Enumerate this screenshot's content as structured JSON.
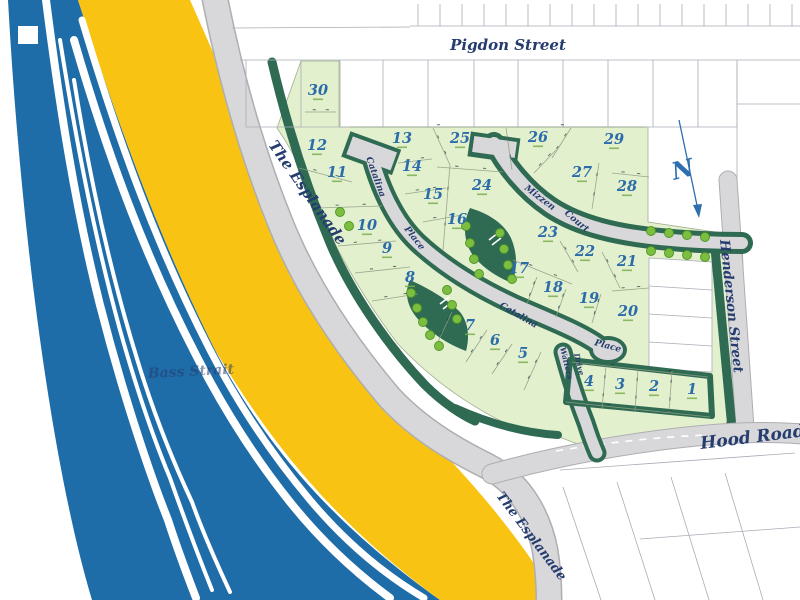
{
  "streets": {
    "pigdon": "Pigdon Street",
    "esplanade_upper": "The Esplanade",
    "esplanade_lower": "The Esplanade",
    "henderson": "Henderson Street",
    "hood": "Hood Road",
    "catalina_upper": "Catalina",
    "place_upper": "Place",
    "catalina_lower": "Catalina",
    "place_lower": "Place",
    "mizzen": "Mizzen",
    "court": "Court",
    "watters": "Watters",
    "drive": "Drive"
  },
  "water": {
    "label": "Bass Strait"
  },
  "compass": {
    "label": "N"
  },
  "lots": [
    {
      "n": "1",
      "x": 692,
      "y": 394
    },
    {
      "n": "2",
      "x": 654,
      "y": 391
    },
    {
      "n": "3",
      "x": 620,
      "y": 389
    },
    {
      "n": "4",
      "x": 589,
      "y": 386
    },
    {
      "n": "5",
      "x": 523,
      "y": 358
    },
    {
      "n": "6",
      "x": 495,
      "y": 345
    },
    {
      "n": "7",
      "x": 470,
      "y": 330
    },
    {
      "n": "8",
      "x": 410,
      "y": 282
    },
    {
      "n": "9",
      "x": 387,
      "y": 253
    },
    {
      "n": "10",
      "x": 367,
      "y": 230
    },
    {
      "n": "11",
      "x": 337,
      "y": 177
    },
    {
      "n": "12",
      "x": 317,
      "y": 150
    },
    {
      "n": "13",
      "x": 402,
      "y": 143
    },
    {
      "n": "14",
      "x": 412,
      "y": 171
    },
    {
      "n": "15",
      "x": 433,
      "y": 199
    },
    {
      "n": "16",
      "x": 457,
      "y": 224
    },
    {
      "n": "17",
      "x": 519,
      "y": 273
    },
    {
      "n": "18",
      "x": 553,
      "y": 292
    },
    {
      "n": "19",
      "x": 589,
      "y": 303
    },
    {
      "n": "20",
      "x": 628,
      "y": 316
    },
    {
      "n": "21",
      "x": 627,
      "y": 266
    },
    {
      "n": "22",
      "x": 585,
      "y": 256
    },
    {
      "n": "23",
      "x": 548,
      "y": 237
    },
    {
      "n": "24",
      "x": 482,
      "y": 190
    },
    {
      "n": "25",
      "x": 460,
      "y": 143
    },
    {
      "n": "26",
      "x": 538,
      "y": 142
    },
    {
      "n": "27",
      "x": 582,
      "y": 177
    },
    {
      "n": "28",
      "x": 627,
      "y": 191
    },
    {
      "n": "29",
      "x": 614,
      "y": 144
    },
    {
      "n": "30",
      "x": 318,
      "y": 95
    }
  ],
  "colors": {
    "water": "#1E6CA8",
    "sand": "#F8C313",
    "lot_fill": "#E3F0CE",
    "verge": "#2F6B52",
    "tree": "#7CBE3F",
    "road": "#D8D8DA",
    "label": "#253C6E",
    "lot_number": "#2B6CA9",
    "area_text": "#79AE4D"
  }
}
